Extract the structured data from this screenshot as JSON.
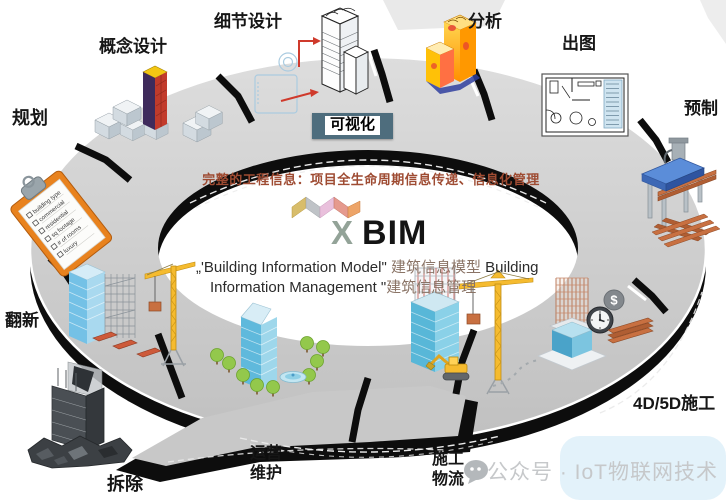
{
  "stages": {
    "planning": "规划",
    "concept_design": "概念设计",
    "detail_design": "细节设计",
    "visualization": "可视化",
    "analysis": "分析",
    "drawing_output": "出图",
    "prefabrication": "预制",
    "construction_4d5d": "4D/5D施工",
    "construction_logistics": [
      "施工",
      "物流"
    ],
    "operation_maintenance": [
      "运营",
      "维护"
    ],
    "renovation": "翻新",
    "demolition": "拆除"
  },
  "center": {
    "info_line": "完整的工程信息：项目全生命周期信息传递、信息化管理",
    "brand_x": "X",
    "brand_bim": "BIM",
    "desc_line1_en1": "„'Building Information Model\" ",
    "desc_line1_cn": "建筑信息模型",
    "desc_line1_en2": "  Building",
    "desc_line2_en": "Information Management \"",
    "desc_line2_cn": "建筑信息管理"
  },
  "checklist": {
    "items": [
      "building type",
      "commercial",
      "residential",
      "sq footage",
      "# of rooms",
      "luxury"
    ]
  },
  "icons": {
    "dollar_sign": "$"
  },
  "watermark": "公众号 · IoT物联网技术",
  "colors": {
    "road": "#c8c8c8",
    "under_band": "#0d0d0d",
    "visualization_box": "#4e6d7d",
    "info_text": "#9e4b32",
    "brand_x": "#93a398",
    "brand_bim": "#141414",
    "crane_yellow": "#f0b429",
    "copper": "#c87041",
    "glass_blue": "#7cc4e8",
    "tree_green": "#93c84c",
    "clipboard_orange": "#e8821e"
  }
}
